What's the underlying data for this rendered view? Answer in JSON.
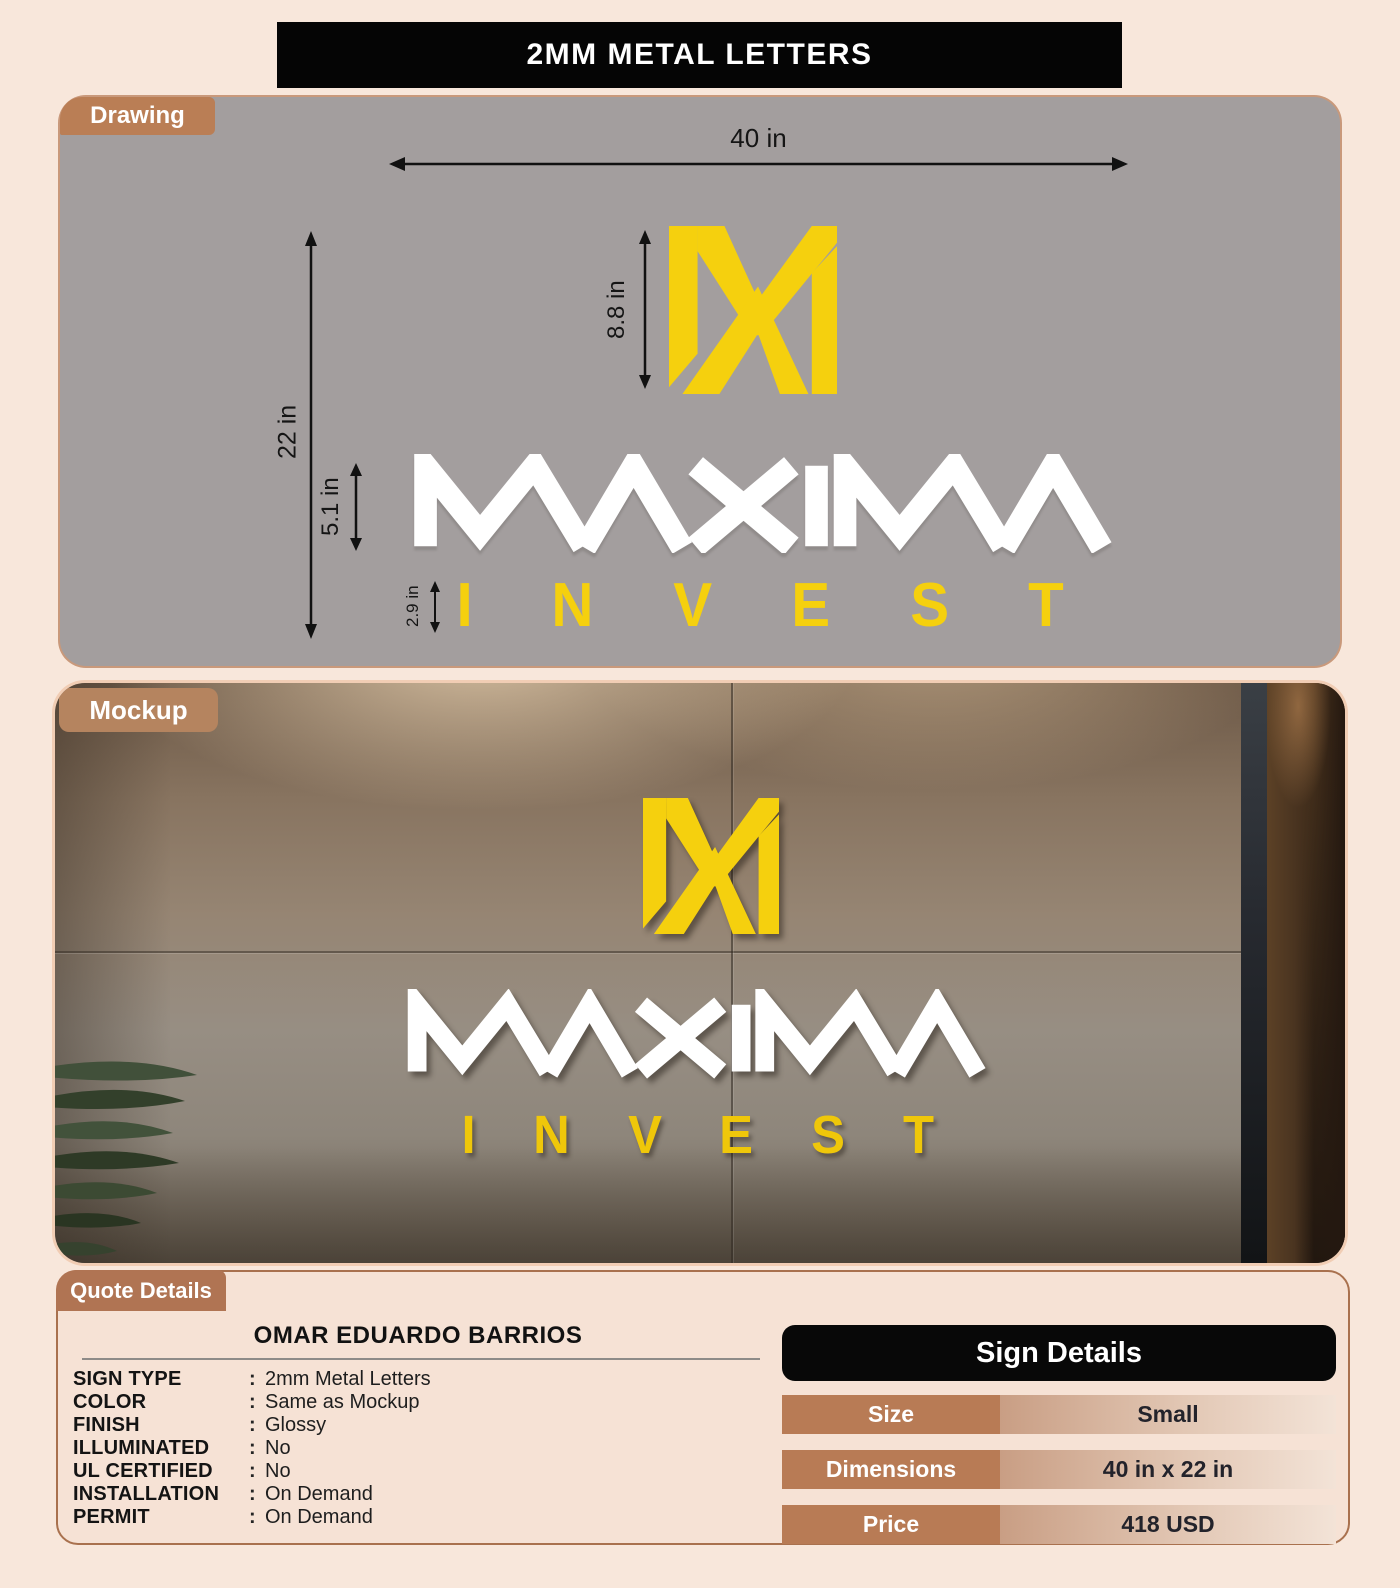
{
  "title": "2MM METAL LETTERS",
  "drawing": {
    "tab_label": "Drawing",
    "dimensions": {
      "width": "40 in",
      "height": "22 in",
      "logo_height": "8.8 in",
      "wordmark_height": "5.1 in",
      "subtext_height": "2.9 in"
    },
    "brand": {
      "name": "MAXIMA",
      "subtext": "INVEST"
    }
  },
  "mockup": {
    "tab_label": "Mockup",
    "brand": {
      "name": "MAXIMA",
      "subtext": "INVEST"
    }
  },
  "quote": {
    "tab_label": "Quote Details",
    "customer_name": "OMAR EDUARDO BARRIOS",
    "colon": ":",
    "fields": [
      {
        "label": "SIGN TYPE",
        "value": "2mm Metal Letters"
      },
      {
        "label": "COLOR",
        "value": "Same as Mockup"
      },
      {
        "label": "FINISH",
        "value": "Glossy"
      },
      {
        "label": "ILLUMINATED",
        "value": "No"
      },
      {
        "label": "UL CERTIFIED",
        "value": "No"
      },
      {
        "label": "INSTALLATION",
        "value": "On Demand"
      },
      {
        "label": "PERMIT",
        "value": "On Demand"
      }
    ]
  },
  "sign_details": {
    "header": "Sign Details",
    "rows": [
      {
        "label": "Size",
        "value": "Small"
      },
      {
        "label": "Dimensions",
        "value": "40 in x 22 in"
      },
      {
        "label": "Price",
        "value": "418 USD"
      }
    ]
  },
  "colors": {
    "page_bg": "#F8E7DB",
    "panel_gray": "#A39E9E",
    "accent_brown": "#BA7E55",
    "brand_yellow": "#F5D00E",
    "black": "#050505",
    "value_gradient_left": "#C99E84",
    "value_gradient_right": "#F3E3D7"
  }
}
